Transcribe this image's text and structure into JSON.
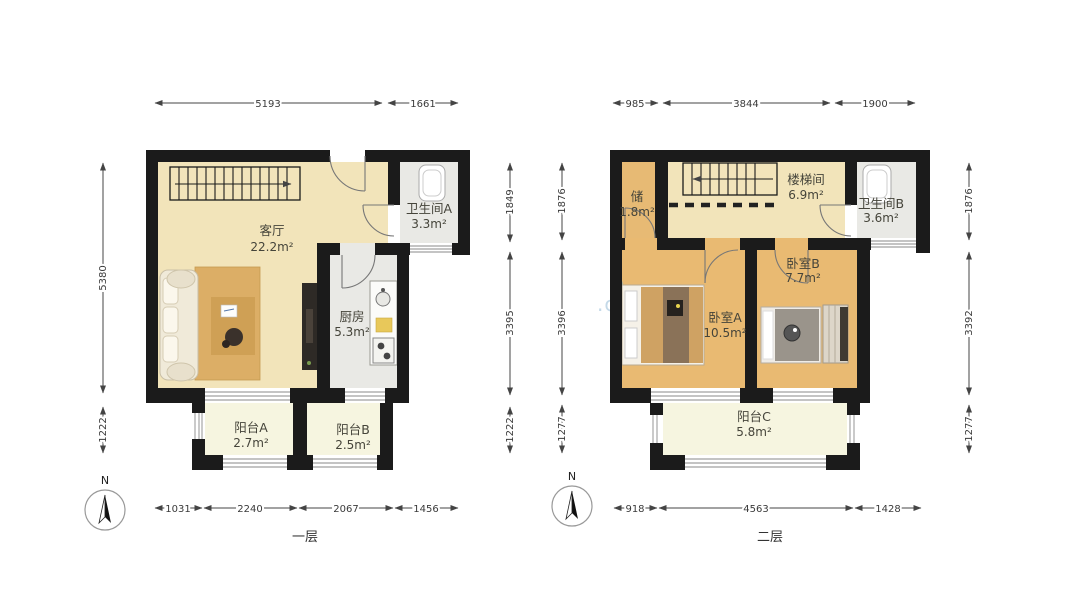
{
  "floor1": {
    "name": "一层",
    "rooms": [
      {
        "label": "客厅",
        "area": "22.2m²"
      },
      {
        "label": "卫生间A",
        "area": "3.3m²"
      },
      {
        "label": "厨房",
        "area": "5.3m²"
      },
      {
        "label": "阳台A",
        "area": "2.7m²"
      },
      {
        "label": "阳台B",
        "area": "2.5m²"
      }
    ],
    "dims": {
      "top": [
        "5193",
        "1661"
      ],
      "left": [
        "5380",
        "1222"
      ],
      "right": [
        "1849",
        "3395",
        "1222"
      ],
      "bottom": [
        "1031",
        "2240",
        "2067",
        "1456"
      ]
    }
  },
  "floor2": {
    "name": "二层",
    "rooms": [
      {
        "label": "储",
        "area": "1.8m²"
      },
      {
        "label": "楼梯间",
        "area": "6.9m²"
      },
      {
        "label": "卫生间B",
        "area": "3.6m²"
      },
      {
        "label": "卧室A",
        "area": "10.5m²"
      },
      {
        "label": "卧室B",
        "area": "7.7m²"
      },
      {
        "label": "阳台C",
        "area": "5.8m²"
      }
    ],
    "dims": {
      "top": [
        "985",
        "3844",
        "1900"
      ],
      "left": [
        "1876",
        "3396",
        "1277"
      ],
      "right": [
        "1876",
        "3392",
        "1277"
      ],
      "bottom": [
        "918",
        "4563",
        "1428"
      ]
    }
  },
  "compass": {
    "north": "N"
  },
  "watermark": ".com",
  "colors": {
    "wall": "#1b1b1b",
    "floor_living": "#f2e4ba",
    "floor_wood": "#e7ba74",
    "floor_tile": "#e9e9e5",
    "floor_balcony": "#f6f5e0"
  }
}
